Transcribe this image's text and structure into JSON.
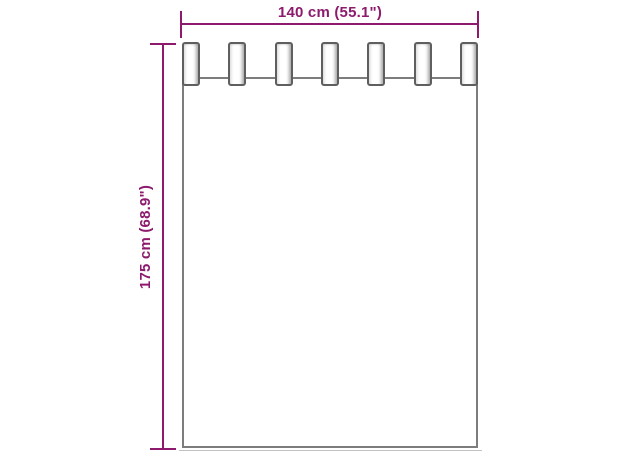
{
  "diagram": {
    "type": "product-dimension-diagram",
    "subject": "tab-top curtain",
    "width_label": "140 cm (55.1\")",
    "height_label": "175 cm (68.9\")",
    "tab_count": 7
  },
  "colors": {
    "dimension": "#8d1a6d",
    "outline": "#7d7d7d",
    "tab_border": "#5f5f5f",
    "background": "#ffffff"
  }
}
